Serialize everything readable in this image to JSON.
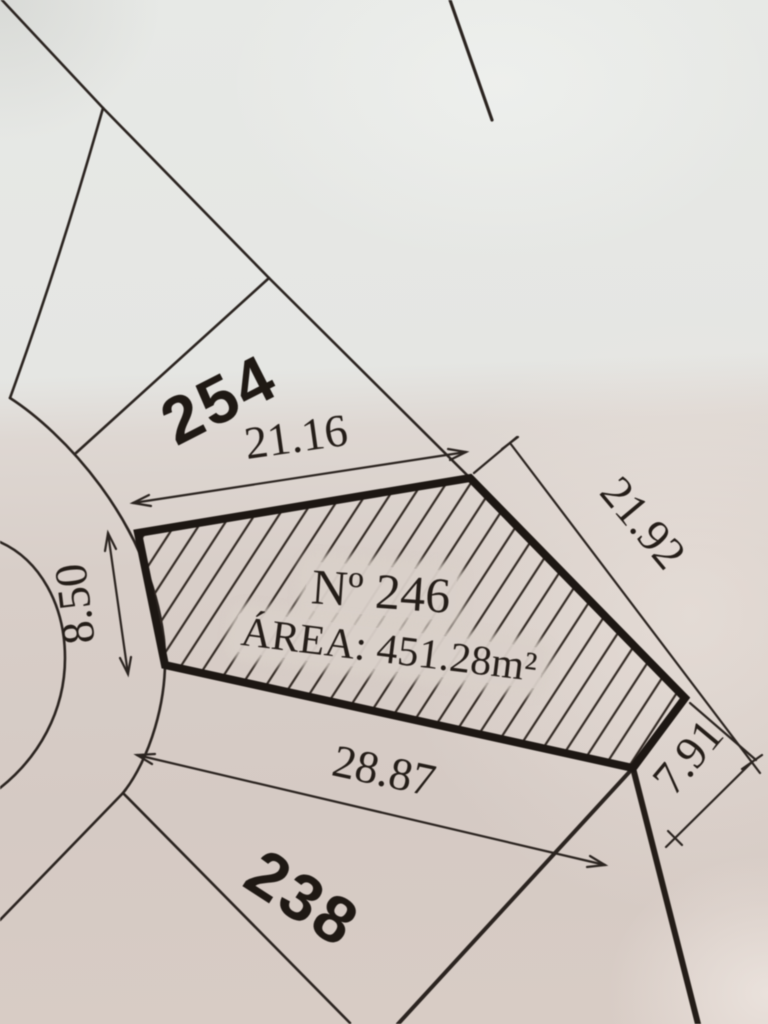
{
  "photo": {
    "description": "Close-up photo of a printed cadastral survey plan"
  },
  "main_lot": {
    "number_label": "Nº 246",
    "area_label": "ÁREA: 451.28m²"
  },
  "dimensions": {
    "top_edge": "21.16",
    "upper_right_edge": "21.92",
    "left_edge": "8.50",
    "bottom_edge": "28.87",
    "lower_right_edge": "7.91"
  },
  "adjacent_lots": {
    "north_lot": "254",
    "south_lot": "238"
  },
  "colors": {
    "ink": "#241d18",
    "paper_light": "#e7e9e6",
    "paper_warm": "#d5cac4"
  }
}
